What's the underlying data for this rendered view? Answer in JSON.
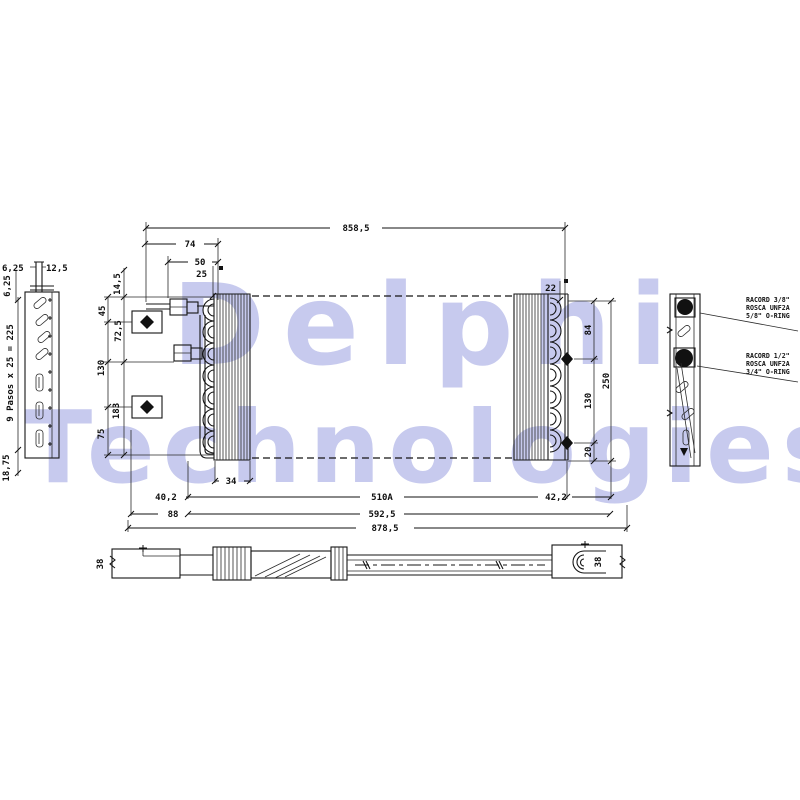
{
  "watermark": {
    "line1": "Delphi",
    "line2": "Technologies",
    "color": "#c7caee"
  },
  "dims": {
    "overall_top": "858,5",
    "d74": "74",
    "d50": "50",
    "d25": "25",
    "d22": "22",
    "d145": "14,5",
    "d45": "45",
    "d725": "72,5",
    "d130_left": "130",
    "d183": "183",
    "d75": "75",
    "d84": "84",
    "d250": "250",
    "d130_right": "130",
    "d20": "20",
    "d34": "34",
    "d402": "40,2",
    "d510a": "510A",
    "d422": "42,2",
    "d88": "88",
    "d5925": "592,5",
    "d8785": "878,5",
    "d625_top": "6,25",
    "d125": "12,5",
    "d625_side": "6,25",
    "pasos": "9 Pasos x 25 = 225",
    "d1875": "18,75",
    "d38_left": "38",
    "d38_right": "38"
  },
  "fittings": {
    "upper": {
      "line1": "RACORD 3/8\"",
      "line2": "ROSCA UNF2A",
      "line3": "5/8\" O-RING"
    },
    "lower": {
      "line1": "RACORD 1/2\"",
      "line2": "ROSCA UNF2A",
      "line3": "3/4\" O-RING"
    }
  }
}
